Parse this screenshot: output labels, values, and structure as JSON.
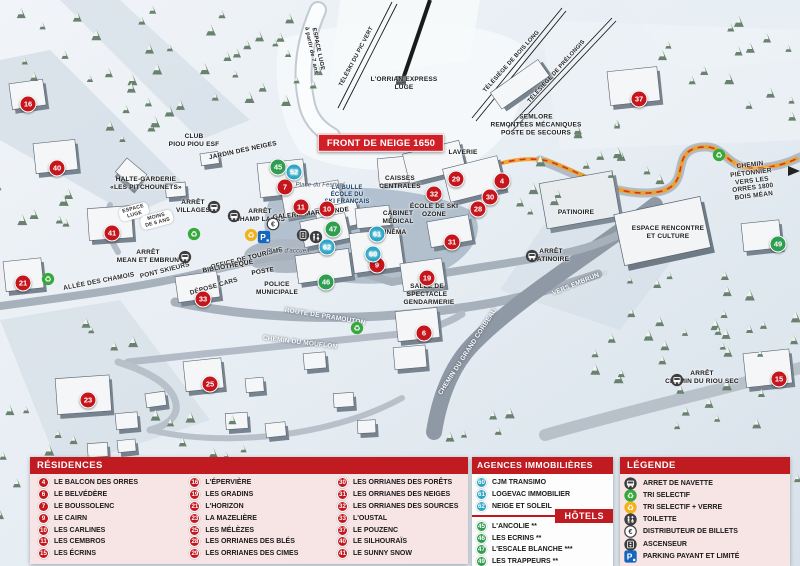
{
  "map": {
    "front_banner": "FRONT DE NEIGE 1650",
    "markers": [
      {
        "n": "16",
        "type": "red",
        "x": 28,
        "y": 104
      },
      {
        "n": "40",
        "type": "red",
        "x": 57,
        "y": 168
      },
      {
        "n": "41",
        "type": "red",
        "x": 112,
        "y": 233
      },
      {
        "n": "21",
        "type": "red",
        "x": 23,
        "y": 283
      },
      {
        "n": "33",
        "type": "red",
        "x": 203,
        "y": 299
      },
      {
        "n": "23",
        "type": "red",
        "x": 88,
        "y": 400
      },
      {
        "n": "25",
        "type": "red",
        "x": 210,
        "y": 384
      },
      {
        "n": "7",
        "type": "red",
        "x": 285,
        "y": 187
      },
      {
        "n": "11",
        "type": "red",
        "x": 301,
        "y": 207
      },
      {
        "n": "10",
        "type": "red",
        "x": 327,
        "y": 209
      },
      {
        "n": "29",
        "type": "red",
        "x": 456,
        "y": 179
      },
      {
        "n": "32",
        "type": "red",
        "x": 434,
        "y": 194
      },
      {
        "n": "4",
        "type": "red",
        "x": 502,
        "y": 181
      },
      {
        "n": "30",
        "type": "red",
        "x": 490,
        "y": 197
      },
      {
        "n": "28",
        "type": "red",
        "x": 478,
        "y": 209
      },
      {
        "n": "31",
        "type": "red",
        "x": 452,
        "y": 242
      },
      {
        "n": "9",
        "type": "red",
        "x": 377,
        "y": 265
      },
      {
        "n": "19",
        "type": "red",
        "x": 427,
        "y": 278
      },
      {
        "n": "6",
        "type": "red",
        "x": 424,
        "y": 333
      },
      {
        "n": "37",
        "type": "red",
        "x": 639,
        "y": 99
      },
      {
        "n": "15",
        "type": "red",
        "x": 779,
        "y": 379
      },
      {
        "n": "45",
        "type": "green",
        "x": 278,
        "y": 167
      },
      {
        "n": "47",
        "type": "green",
        "x": 333,
        "y": 229
      },
      {
        "n": "46",
        "type": "green",
        "x": 326,
        "y": 282
      },
      {
        "n": "49",
        "type": "green",
        "x": 778,
        "y": 244
      },
      {
        "n": "52",
        "type": "blue",
        "x": 294,
        "y": 172
      },
      {
        "n": "62",
        "type": "blue",
        "x": 327,
        "y": 247
      },
      {
        "n": "61",
        "type": "blue",
        "x": 377,
        "y": 234
      },
      {
        "n": "60",
        "type": "blue",
        "x": 373,
        "y": 254
      }
    ],
    "labels": [
      {
        "t": "FRONT DE NEIGE 1650",
        "x": 381,
        "y": 143,
        "cls": "banner"
      },
      {
        "t": "L'ORRIAN EXPRESS\nLUGE",
        "x": 404,
        "y": 84,
        "cls": "poi"
      },
      {
        "t": "TÉLÉSKI DU PIC VERT",
        "x": 357,
        "y": 57,
        "rot": -62,
        "cls": "lift"
      },
      {
        "t": "TÉLÉSIÈGE DE BOIS LONG",
        "x": 512,
        "y": 62,
        "rot": -48,
        "cls": "lift"
      },
      {
        "t": "TÉLÉSIÈGE DE PRÉLONGIS",
        "x": 557,
        "y": 72,
        "rot": -48,
        "cls": "lift"
      },
      {
        "t": "ESPACE LUGE\nà partir de 7 ans",
        "x": 314,
        "y": 50,
        "rot": 78,
        "cls": "lift"
      },
      {
        "t": "CLUB\nPIOU PIOU ESF",
        "x": 194,
        "y": 141,
        "cls": "poi"
      },
      {
        "t": "JARDIN DES NEIGES",
        "x": 243,
        "y": 151,
        "rot": -12,
        "cls": "poi"
      },
      {
        "t": "HALTE-GARDERIE\n«LES PITCHOUNETS»",
        "x": 146,
        "y": 184,
        "cls": "poi"
      },
      {
        "t": "ESPACE\nLUGE",
        "x": 134,
        "y": 212,
        "rot": -15,
        "cls": "pill"
      },
      {
        "t": "MOINS\nDE 6 ANS",
        "x": 157,
        "y": 220,
        "rot": -15,
        "cls": "pill"
      },
      {
        "t": "ARRÊT\nVILLAGES",
        "x": 193,
        "y": 207,
        "cls": "poi"
      },
      {
        "t": "ARRÊT\nCHAMP LACAS",
        "x": 260,
        "y": 216,
        "cls": "poi"
      },
      {
        "t": "ARRÊT\nMEAN ET EMBRUN",
        "x": 148,
        "y": 257,
        "cls": "poi"
      },
      {
        "t": "PONT SKIEURS",
        "x": 165,
        "y": 271,
        "rot": -14,
        "cls": "road-dark"
      },
      {
        "t": "ALLÉE DES CHAMOIS",
        "x": 99,
        "y": 282,
        "rot": -11,
        "cls": "road-dark"
      },
      {
        "t": "ROUTE DE PRAMOUTON",
        "x": 325,
        "y": 317,
        "rot": 9,
        "cls": "road-light"
      },
      {
        "t": "CHEMIN DU MOUFLON",
        "x": 300,
        "y": 343,
        "rot": 7,
        "cls": "road-light"
      },
      {
        "t": "CHEMIN DU GRAND CORBEAU",
        "x": 468,
        "y": 352,
        "rot": -57,
        "cls": "road-light"
      },
      {
        "t": "VERS EMBRUN →",
        "x": 580,
        "y": 283,
        "rot": -22,
        "cls": "road-light"
      },
      {
        "t": "ARRÊT\nPATINOIRE",
        "x": 551,
        "y": 256,
        "cls": "poi"
      },
      {
        "t": "PATINOIRE",
        "x": 576,
        "y": 213,
        "cls": "poi"
      },
      {
        "t": "ESPACE RENCONTRE\nET CULTURE",
        "x": 668,
        "y": 233,
        "cls": "poi"
      },
      {
        "t": "SEMLORE\nREMONTÉES MÉCANIQUES\nPOSTE DE SECOURS",
        "x": 536,
        "y": 125,
        "cls": "poi"
      },
      {
        "t": "CHEMIN PIÉTONNIER\nVERS LES ORRES 1800\nBOIS MÉAN",
        "x": 752,
        "y": 181,
        "rot": -7,
        "cls": "road-dark"
      },
      {
        "t": "ARRÊT\nCHEMIN DU RIOU SEC",
        "x": 702,
        "y": 378,
        "cls": "poi"
      },
      {
        "t": "CAISSES\nCENTRALES",
        "x": 400,
        "y": 183,
        "cls": "poi"
      },
      {
        "t": "CABINET\nMÉDICAL",
        "x": 398,
        "y": 218,
        "cls": "poi"
      },
      {
        "t": "CINÉMA",
        "x": 393,
        "y": 233,
        "cls": "poi"
      },
      {
        "t": "LAVERIE",
        "x": 463,
        "y": 153,
        "cls": "poi"
      },
      {
        "t": "GALERIE MARCHANDE",
        "x": 311,
        "y": 214,
        "rot": -6,
        "cls": "poi"
      },
      {
        "t": "LA BULLE\nÉCOLE DU\nSKI FRANÇAIS",
        "x": 347,
        "y": 196,
        "cls": "blue"
      },
      {
        "t": "ÉCOLE DE SKI\nOZONE",
        "x": 434,
        "y": 211,
        "cls": "poi"
      },
      {
        "t": "SALLE DE\nSPECTACLE",
        "x": 427,
        "y": 291,
        "cls": "poi"
      },
      {
        "t": "GENDARMERIE",
        "x": 429,
        "y": 303,
        "cls": "poi"
      },
      {
        "t": "OFFICE DE TOURISME",
        "x": 247,
        "y": 259,
        "rot": -14,
        "cls": "poi"
      },
      {
        "t": "BIBLIOTHÈQUE",
        "x": 228,
        "y": 267,
        "rot": -10,
        "cls": "poi"
      },
      {
        "t": "POSTE",
        "x": 263,
        "y": 272,
        "rot": -10,
        "cls": "poi"
      },
      {
        "t": "POLICE\nMUNICIPALE",
        "x": 277,
        "y": 289,
        "cls": "poi"
      },
      {
        "t": "DÉPOSE CARS",
        "x": 214,
        "y": 287,
        "rot": -16,
        "cls": "road-dark"
      },
      {
        "t": "Place d'accueil",
        "x": 288,
        "y": 252,
        "cls": "place"
      },
      {
        "t": "Place du Festival",
        "x": 320,
        "y": 186,
        "cls": "place"
      }
    ],
    "icons": [
      {
        "type": "bus",
        "x": 214,
        "y": 207
      },
      {
        "type": "bus",
        "x": 234,
        "y": 216
      },
      {
        "type": "bus",
        "x": 185,
        "y": 257
      },
      {
        "type": "bus",
        "x": 532,
        "y": 256
      },
      {
        "type": "bus",
        "x": 677,
        "y": 380
      },
      {
        "type": "recycle-green",
        "x": 48,
        "y": 279
      },
      {
        "type": "recycle-green",
        "x": 194,
        "y": 234
      },
      {
        "type": "recycle-green",
        "x": 357,
        "y": 328
      },
      {
        "type": "recycle-green",
        "x": 719,
        "y": 155
      },
      {
        "type": "recycle-yellow",
        "x": 251,
        "y": 235
      },
      {
        "type": "parking",
        "x": 264,
        "y": 237
      },
      {
        "type": "euro",
        "x": 273,
        "y": 224
      },
      {
        "type": "elevator",
        "x": 303,
        "y": 235
      },
      {
        "type": "toilet",
        "x": 316,
        "y": 237
      }
    ]
  },
  "panels": {
    "residences": {
      "title": "RÉSIDENCES",
      "columns": [
        [
          {
            "n": "4",
            "label": "LE BALCON DES ORRES"
          },
          {
            "n": "6",
            "label": "LE BELVÉDÈRE"
          },
          {
            "n": "7",
            "label": "LE BOUSSOLENC"
          },
          {
            "n": "9",
            "label": "LE CAIRN"
          },
          {
            "n": "10",
            "label": "LES CARLINES"
          },
          {
            "n": "11",
            "label": "LES CEMBROS"
          },
          {
            "n": "15",
            "label": "LES ÉCRINS"
          }
        ],
        [
          {
            "n": "16",
            "label": "L'ÉPERVIÈRE"
          },
          {
            "n": "19",
            "label": "LES GRADINS"
          },
          {
            "n": "21",
            "label": "L'HORIZON"
          },
          {
            "n": "23",
            "label": "LA MAZELIÈRE"
          },
          {
            "n": "25",
            "label": "LES MÉLÈZES"
          },
          {
            "n": "28",
            "label": "LES ORRIANES DES BLÉS"
          },
          {
            "n": "29",
            "label": "LES ORRIANES DES CIMES"
          }
        ],
        [
          {
            "n": "30",
            "label": "LES ORRIANES DES FORÊTS"
          },
          {
            "n": "31",
            "label": "LES ORRIANES DES NEIGES"
          },
          {
            "n": "32",
            "label": "LES ORRIANES DES SOURCES"
          },
          {
            "n": "33",
            "label": "L'OUSTAL"
          },
          {
            "n": "37",
            "label": "LE POUZENC"
          },
          {
            "n": "40",
            "label": "LE SILHOURAÏS"
          },
          {
            "n": "41",
            "label": "LE SUNNY SNOW"
          }
        ]
      ]
    },
    "agences": {
      "title": "AGENCES IMMOBILIÈRES",
      "items": [
        {
          "n": "60",
          "label": "CJM TRANSIMO"
        },
        {
          "n": "61",
          "label": "LOGEVAC IMMOBILIER"
        },
        {
          "n": "62",
          "label": "NEIGE ET SOLEIL"
        }
      ]
    },
    "hotels": {
      "title": "HÔTELS",
      "items": [
        {
          "n": "45",
          "label": "L'ANCOLIE **"
        },
        {
          "n": "46",
          "label": "LES ECRINS **"
        },
        {
          "n": "47",
          "label": "L'ESCALE BLANCHE ***"
        },
        {
          "n": "49",
          "label": "LES TRAPPEURS **"
        }
      ]
    },
    "legende": {
      "title": "LÉGENDE",
      "items": [
        {
          "icon": "bus",
          "label": "ARRET DE NAVETTE"
        },
        {
          "icon": "recycle-green",
          "label": "TRI SELECTIF"
        },
        {
          "icon": "recycle-yellow",
          "label": "TRI SELECTIF + VERRE"
        },
        {
          "icon": "toilet",
          "label": "TOILETTE"
        },
        {
          "icon": "euro",
          "label": "DISTRIBUTEUR DE BILLETS"
        },
        {
          "icon": "elevator",
          "label": "ASCENSEUR"
        },
        {
          "icon": "parking",
          "label": "PARKING PAYANT ET LIMITÉ"
        }
      ]
    }
  },
  "colors": {
    "residence_marker": "#c4161c",
    "agence_marker": "#2aa5c6",
    "hotel_marker": "#2f9e50",
    "panel_header": "#c01b20",
    "panel_pink": "#f7e4e5",
    "path_orange": "#f0a01e"
  }
}
